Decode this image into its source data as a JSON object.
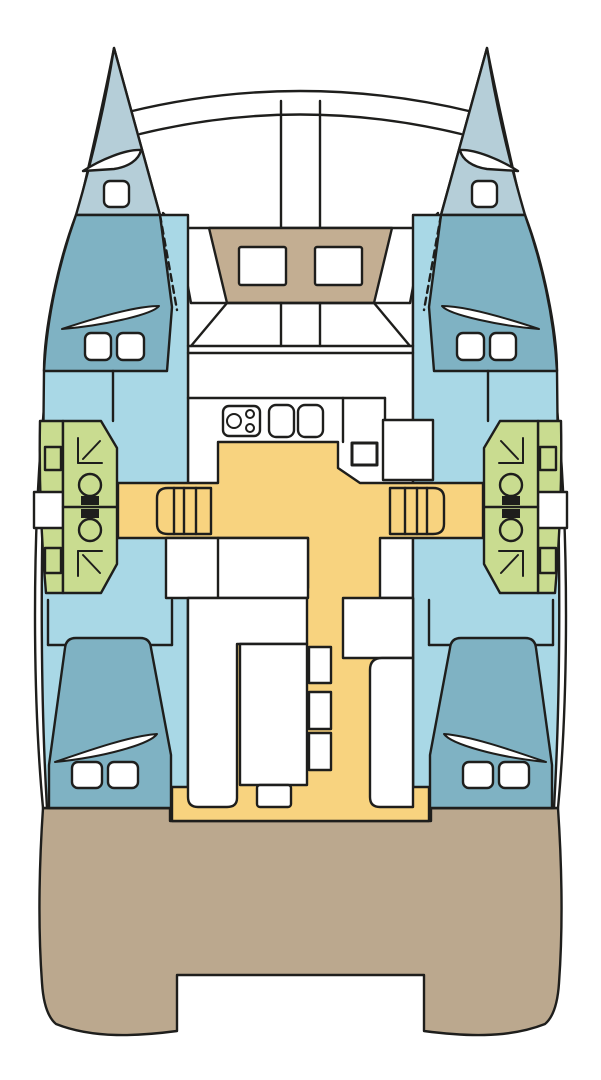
{
  "diagram": {
    "name": "catamaran-deck-plan",
    "type": "boat-floor-plan",
    "orientation": "bow-up",
    "text_labels": []
  },
  "colors": {
    "background": "#ffffff",
    "outline": "#1e1e1c",
    "white": "#ffffff",
    "bow": "#b5ced8",
    "cabin_floor": "#a9d8e6",
    "berth": "#7fb2c3",
    "head_compartment": "#c9dc90",
    "cabin_sole": "#f8d37f",
    "foredeck_seat": "#c3ae92",
    "aft_deck": "#bba88e",
    "toilet_tank": "#1e1e1c"
  },
  "regions": {
    "port_bow": "port bow locker",
    "starboard_bow": "starboard bow locker",
    "trampoline": "foredeck trampoline",
    "foredeck_seat": "forward cockpit seat",
    "port_forward_cabin": "port forward berth",
    "starboard_forward_cabin": "starboard forward berth",
    "port_head": "port heads and shower",
    "starboard_head": "starboard heads and shower",
    "galley": "galley with stove and twin sinks",
    "nav_station": "navigation station",
    "salon": "salon with settee and table",
    "companionway": "companionway steps",
    "port_aft_cabin": "port aft berth",
    "starboard_aft_cabin": "starboard aft berth",
    "cockpit": "aft cockpit sole",
    "aft_deck": "aft deck and transom steps"
  }
}
